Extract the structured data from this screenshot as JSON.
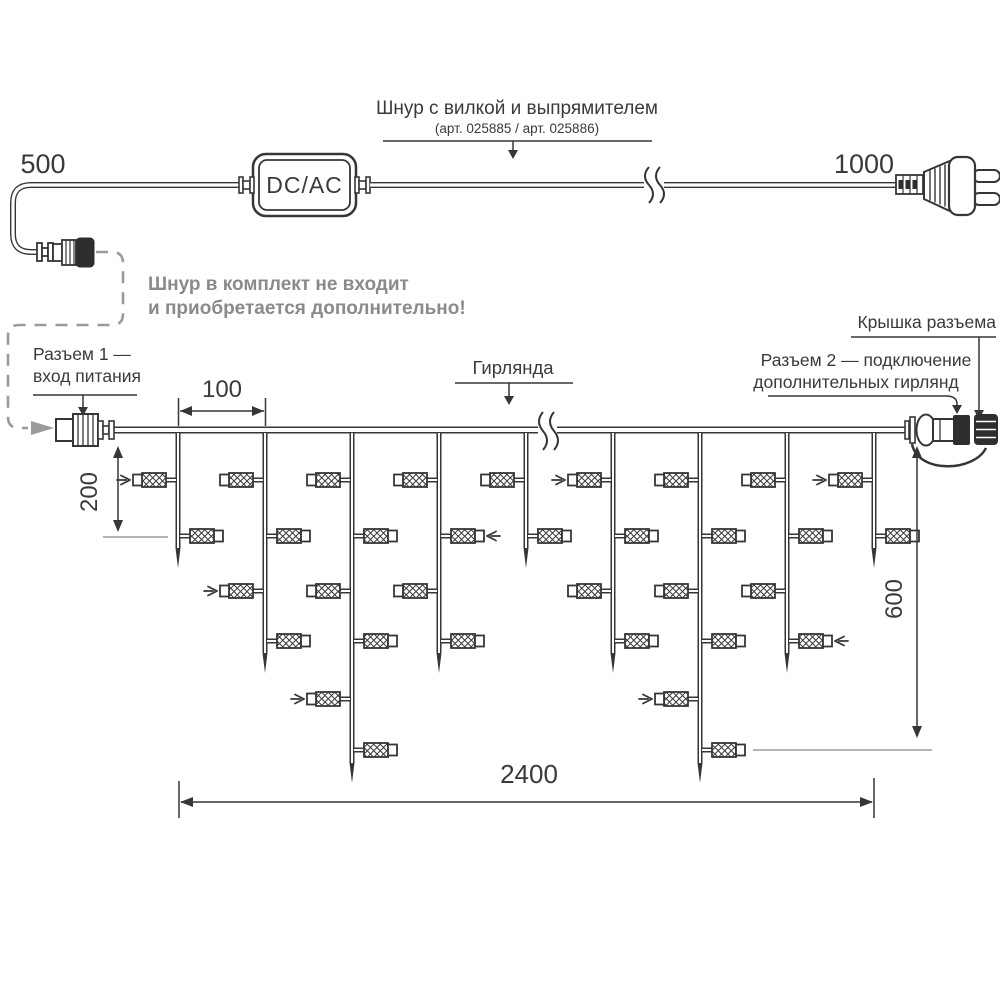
{
  "colors": {
    "line": "#363636",
    "gray": "#9a9a9a",
    "note_text": "#8a8a8a",
    "background": "#ffffff"
  },
  "power_cord": {
    "title": "Шнур с вилкой и выпрямителем",
    "subtitle": "(арт. 025885 / арт. 025886)",
    "left_length": "500",
    "right_length": "1000",
    "converter_label": "DC/AC",
    "note_line1": "Шнур в комплект не входит",
    "note_line2": "и приобретается дополнительно!"
  },
  "garland": {
    "connector1_label_line1": "Разъем 1 —",
    "connector1_label_line2": "вход питания",
    "garland_label": "Гирлянда",
    "cap_label": "Крышка разъема",
    "connector2_label_line1": "Разъем 2 — подключение",
    "connector2_label_line2": "дополнительных гирлянд",
    "dim_spacing": "100",
    "dim_first_drop": "200",
    "dim_max_drop": "600",
    "dim_total_length": "2400"
  },
  "structure": {
    "wire_y": 430,
    "lamp_row_y": [
      480,
      536,
      591,
      641,
      699,
      750
    ],
    "tip_y": {
      "short": 568,
      "medium": 673,
      "long": 783
    },
    "drops": [
      {
        "length": "short",
        "lamps": [
          {
            "row": 0,
            "side": "left",
            "arrow": true
          },
          {
            "row": 1,
            "side": "right",
            "arrow": false
          }
        ]
      },
      {
        "length": "medium",
        "lamps": [
          {
            "row": 0,
            "side": "left",
            "arrow": false
          },
          {
            "row": 1,
            "side": "right",
            "arrow": false
          },
          {
            "row": 2,
            "side": "left",
            "arrow": true
          },
          {
            "row": 3,
            "side": "right",
            "arrow": false
          }
        ]
      },
      {
        "length": "long",
        "lamps": [
          {
            "row": 0,
            "side": "left",
            "arrow": false
          },
          {
            "row": 1,
            "side": "right",
            "arrow": false
          },
          {
            "row": 2,
            "side": "left",
            "arrow": false
          },
          {
            "row": 3,
            "side": "right",
            "arrow": false
          },
          {
            "row": 4,
            "side": "left",
            "arrow": true
          },
          {
            "row": 5,
            "side": "right",
            "arrow": false
          }
        ]
      },
      {
        "length": "medium",
        "lamps": [
          {
            "row": 0,
            "side": "left",
            "arrow": false
          },
          {
            "row": 1,
            "side": "right",
            "arrow": true
          },
          {
            "row": 2,
            "side": "left",
            "arrow": false
          },
          {
            "row": 3,
            "side": "right",
            "arrow": false
          }
        ]
      },
      {
        "length": "short",
        "lamps": [
          {
            "row": 0,
            "side": "left",
            "arrow": false
          },
          {
            "row": 1,
            "side": "right",
            "arrow": false
          }
        ]
      },
      {
        "length": "medium",
        "lamps": [
          {
            "row": 0,
            "side": "left",
            "arrow": true
          },
          {
            "row": 1,
            "side": "right",
            "arrow": false
          },
          {
            "row": 2,
            "side": "left",
            "arrow": false
          },
          {
            "row": 3,
            "side": "right",
            "arrow": false
          }
        ]
      },
      {
        "length": "long",
        "lamps": [
          {
            "row": 0,
            "side": "left",
            "arrow": false
          },
          {
            "row": 1,
            "side": "right",
            "arrow": false
          },
          {
            "row": 2,
            "side": "left",
            "arrow": false
          },
          {
            "row": 3,
            "side": "right",
            "arrow": false
          },
          {
            "row": 4,
            "side": "left",
            "arrow": true
          },
          {
            "row": 5,
            "side": "right",
            "arrow": false
          }
        ]
      },
      {
        "length": "medium",
        "lamps": [
          {
            "row": 0,
            "side": "left",
            "arrow": false
          },
          {
            "row": 1,
            "side": "right",
            "arrow": false
          },
          {
            "row": 2,
            "side": "left",
            "arrow": false
          },
          {
            "row": 3,
            "side": "right",
            "arrow": true
          }
        ]
      },
      {
        "length": "short",
        "lamps": [
          {
            "row": 0,
            "side": "left",
            "arrow": true
          },
          {
            "row": 1,
            "side": "right",
            "arrow": false
          }
        ]
      }
    ]
  }
}
